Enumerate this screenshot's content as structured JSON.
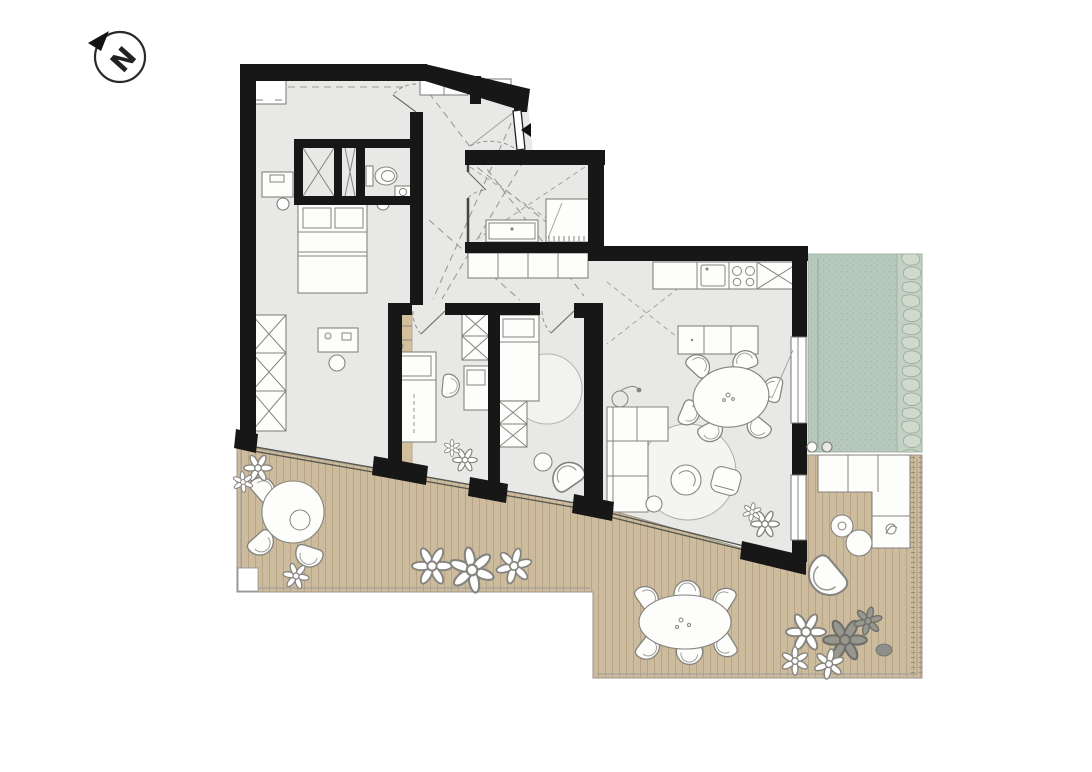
{
  "compass": {
    "label": "N"
  },
  "palette": {
    "background": "#ffffff",
    "wall": "#171717",
    "floor": "#e8e8e6",
    "deck": "#ccbb9c",
    "deck_plank_line": "#b7a384",
    "wood_accent": "#d2c09c",
    "green_area": "#b6c9bc",
    "green_dot": "#a2b7aa",
    "pebble_fill": "#cfdacd",
    "furniture_stroke": "#85847f",
    "furniture_fill": "#fdfdfc",
    "rug_fill": "#f4f4f2",
    "glass_line": "#55554f",
    "dashed_guide": "#9b9b98",
    "entrance_marker": "#111111"
  },
  "elements": {
    "icons": [
      "north-arrow-icon",
      "entrance-arrow-icon"
    ],
    "fixtures": [
      "double-bed",
      "single-bed",
      "wardrobe",
      "dresser",
      "dressing-table",
      "toilet",
      "hand-basin",
      "vanity",
      "shower",
      "hall-closet",
      "kitchen-counter",
      "kitchen-sink",
      "stove",
      "tall-unit",
      "sideboard",
      "dining-table",
      "dining-chair",
      "corner-sofa",
      "coffee-table",
      "armchair",
      "rug",
      "floor-lamp",
      "desk",
      "desk-chair",
      "plant",
      "terrace-deck",
      "planted-area",
      "pebble-border",
      "outdoor-sofa",
      "outdoor-dining-table",
      "bistro-table",
      "lounge-chair",
      "side-table"
    ]
  }
}
